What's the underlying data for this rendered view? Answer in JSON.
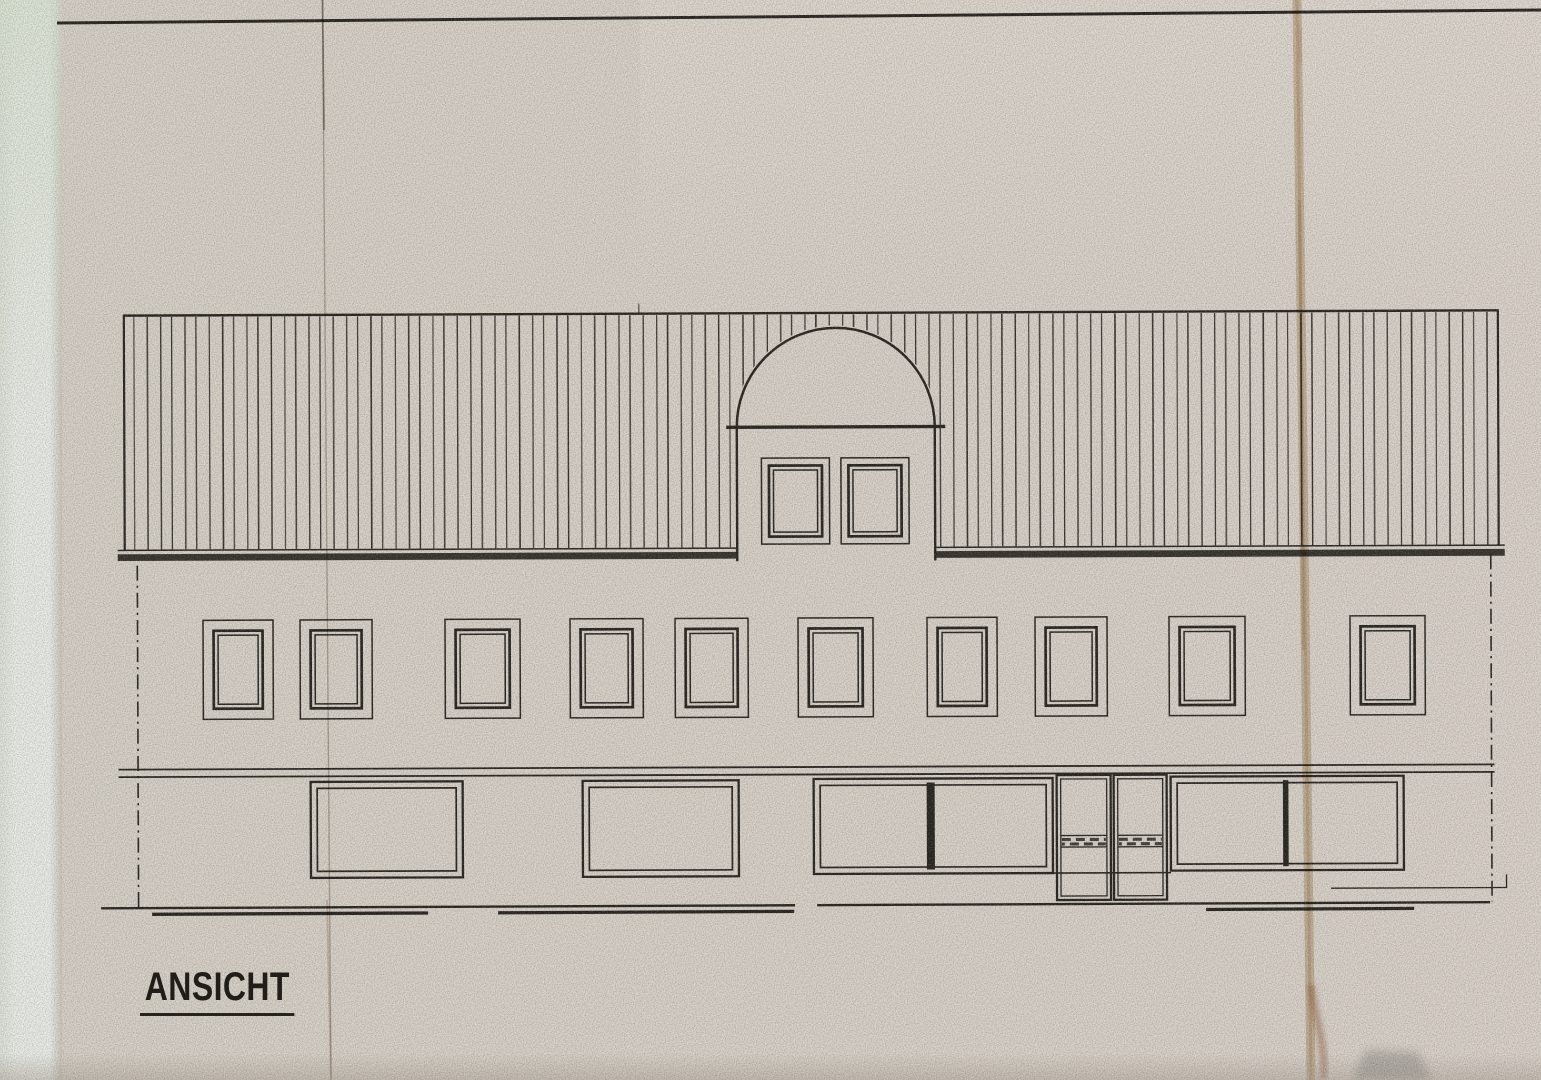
{
  "document": {
    "type": "scanned architectural elevation drawing",
    "title": {
      "label": "ANSICHT",
      "underlined": true
    },
    "paper": {
      "base_color": "#d8d2c8",
      "ink_color": "#2a2621",
      "left_strip_color": "#ebede7",
      "crease_tan": "#c2a787",
      "stain_red": "#9c5b39"
    },
    "elevation": {
      "top_border": {
        "x1": 57,
        "y1": 23,
        "x2": 1541,
        "y2": 10,
        "w": 3
      },
      "roof": {
        "x": 124,
        "y": 313,
        "w": 1376,
        "h": 235,
        "hatch_spacing": 12.4
      },
      "eave": {
        "line_y": 547.8,
        "band_y": 551.6,
        "band_h": 6.8,
        "left_x": 118,
        "right_x": 1505
      },
      "dormer": {
        "left": 737.5,
        "right": 935.5,
        "base_y": 427,
        "arch_r": 99,
        "side_bottom": 561,
        "base_x1": 727,
        "base_x2": 946,
        "window_inset_mid": 7.5,
        "window_inset_inner": 12,
        "windows": [
          [
            762,
            458,
            68,
            86
          ],
          [
            841.5,
            458,
            68,
            86
          ]
        ]
      },
      "upper_windows": {
        "y": 618,
        "h": 99,
        "inset_mid": 10.5,
        "inset_inner": 15,
        "items": [
          [
            203,
            70
          ],
          [
            300,
            72
          ],
          [
            445,
            75
          ],
          [
            570,
            73
          ],
          [
            675,
            73
          ],
          [
            798,
            75
          ],
          [
            927,
            70
          ],
          [
            1035,
            72
          ],
          [
            1169,
            76
          ],
          [
            1350,
            75
          ]
        ]
      },
      "floor_band": {
        "x1": 118,
        "x2": 1494,
        "y1": 767,
        "y2": 774.5,
        "w": 1.8
      },
      "side_lines": {
        "left": {
          "x": 137.5,
          "y1": 563,
          "y2": 905.5
        },
        "right": {
          "x": 1491,
          "y1": 557,
          "y2": 904
        },
        "dash": "15 5 2.2 5",
        "w": 1.6
      },
      "gf_windows": [
        {
          "x": 310,
          "y": 780,
          "w": 152,
          "h": 96
        },
        {
          "x": 582,
          "y": 780,
          "w": 156,
          "h": 96
        },
        {
          "x": 813,
          "y": 779,
          "w": 239,
          "h": 95,
          "divider_x": 930,
          "divider_w": 8
        },
        {
          "x": 1170,
          "y": 778,
          "w": 233,
          "h": 94,
          "divider_x": 1285,
          "divider_w": 5.5
        }
      ],
      "gf_window_inset": 6.5,
      "doors": {
        "y": 776,
        "h": 125,
        "inner_inset": 4,
        "band_y1": 836.5,
        "band_y2": 848,
        "dash_rows": [
          840.5,
          845
        ],
        "leaves": [
          [
            1056,
            54
          ],
          [
            1113,
            53
          ]
        ]
      },
      "sill_link": {
        "x1": 1052,
        "x2": 1170,
        "y": 874,
        "w": 1.6
      },
      "ground_lines": {
        "main": {
          "w": 2.4,
          "segments": [
            [
              100,
              905.6,
              794
            ],
            [
              816,
              905.2,
              1489
            ]
          ]
        },
        "heavy": {
          "w": 3.3,
          "segments": [
            [
              151,
              911.8,
              427
            ],
            [
              497,
              911.6,
              793
            ],
            [
              1205,
              911,
              1413
            ]
          ]
        },
        "step_h": {
          "x1": 1330,
          "y": 890.2,
          "x2": 1506,
          "w": 1.3
        },
        "step_v": {
          "x": 1505.5,
          "y1": 877,
          "y2": 890.5,
          "w": 1.3
        }
      },
      "tick_mark": {
        "x": 640,
        "y1": 303,
        "y2": 313.5,
        "w": 1.3
      }
    }
  }
}
